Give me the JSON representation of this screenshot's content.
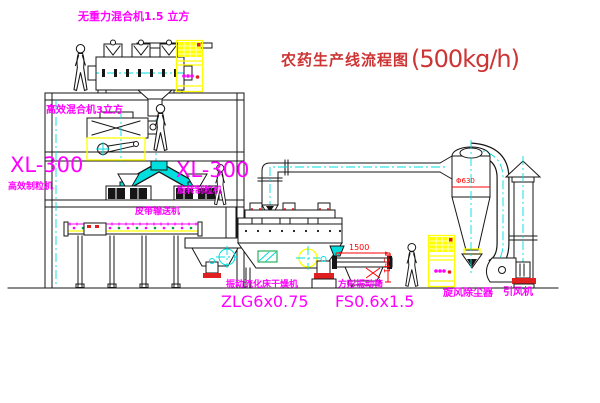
{
  "title": {
    "text": "农药生产线流程图",
    "capacity": "(500kg/h)"
  },
  "labels": {
    "gravity_mixer": "无重力混合机1.5 立方",
    "high_eff_mixer": "高效混合机3立方",
    "granulator_left_model": "XL-300",
    "granulator_left_name": "高效制粒机",
    "granulator_right_model": "XL-300",
    "granulator_right_name": "旋转制粒机",
    "belt_conveyor": "皮带输送机",
    "fluid_bed_dryer_name": "振动流化床干燥机",
    "fluid_bed_dryer_model": "ZLG6x0.75",
    "vibrating_screen_name": "方形振动筛",
    "vibrating_screen_model": "FS0.6x1.5",
    "cyclone_collector": "旋风除尘器",
    "induced_draft_fan": "引风机"
  },
  "dimensions": {
    "screen_length": "1500",
    "screen_height": "541",
    "cyclone_note": "Φ630"
  },
  "figures": {
    "worker_count": 4
  },
  "colors": {
    "label_magenta": "#ff00ff",
    "title_red": "#cd3434",
    "dimension_red": "#ff0000",
    "centerline_cyan": "#00dede",
    "highlight_yellow": "#ffff00",
    "line_black": "#161616",
    "plate_green": "#00a040",
    "background": "#ffffff"
  }
}
